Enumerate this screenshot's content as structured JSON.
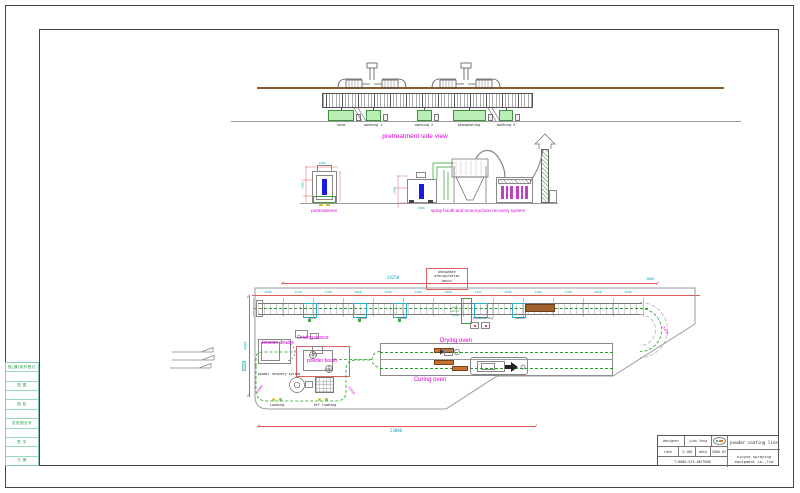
{
  "frame": {
    "left_strip_rows": [
      "借(通)用件登记",
      "",
      "描 图",
      "",
      "描 校",
      "",
      "旧底图总号",
      "",
      "签 字",
      "",
      "日 期"
    ]
  },
  "side_view": {
    "caption": "pretreatment side view",
    "tanks": [
      {
        "label": "skim",
        "cx": 341
      },
      {
        "label": "washing 1",
        "cx": 373
      },
      {
        "label": "washing 2",
        "cx": 424
      },
      {
        "label": "phosphating",
        "cx": 469
      },
      {
        "label": "washing 3",
        "cx": 506
      }
    ]
  },
  "sections": {
    "pretreatment": "pretreatment",
    "spray": "spray booth and monocyclone recovery system",
    "dims": [
      {
        "text": "2200",
        "x": 303,
        "y": 184,
        "rot": -90
      },
      {
        "text": "1500",
        "x": 322,
        "y": 162
      },
      {
        "text": "2200",
        "x": 395,
        "y": 189,
        "rot": -90
      },
      {
        "text": "1500",
        "x": 421,
        "y": 207
      }
    ]
  },
  "plan": {
    "labels": {
      "tension_device": "tension device",
      "driving_device": "Driving device",
      "powder_booth": "powder booth",
      "powder_recovery": "powder recovery system",
      "drying_oven": "Drying oven",
      "curing_oven": "Curing oven",
      "loading": "Loading",
      "off_loading": "Off loading"
    },
    "stations": [
      {
        "label": "skim",
        "cx": 312
      },
      {
        "label": "wash1",
        "cx": 362
      },
      {
        "label": "wash2",
        "cx": 402
      },
      {
        "label": "phosphating",
        "cx": 483
      },
      {
        "label": "wash3",
        "cx": 520
      }
    ],
    "basin_lines": [
      "phosphate",
      "precipitation",
      "basin"
    ],
    "hot_water_lines": [
      "hot",
      "water",
      "tank"
    ],
    "radius_callouts": [
      {
        "text": "1500R",
        "x": 260,
        "y": 388,
        "rot": -55
      },
      {
        "text": "1500R",
        "x": 351,
        "y": 389,
        "rot": 55
      },
      {
        "text": "2000R",
        "x": 665,
        "y": 329,
        "rot": 60
      }
    ],
    "dims": {
      "total_top": "24250",
      "bottom": "23000",
      "left": "4500",
      "right": "1000",
      "segments": [
        {
          "text": "1500",
          "x": 268
        },
        {
          "text": "1570",
          "x": 298
        },
        {
          "text": "1700",
          "x": 328
        },
        {
          "text": "2000",
          "x": 358
        },
        {
          "text": "1650",
          "x": 388
        },
        {
          "text": "1500",
          "x": 418
        },
        {
          "text": "1000",
          "x": 448
        },
        {
          "text": "1443",
          "x": 478
        },
        {
          "text": "1500",
          "x": 508
        },
        {
          "text": "1400",
          "x": 538
        },
        {
          "text": "1700",
          "x": 568
        },
        {
          "text": "1650",
          "x": 598
        },
        {
          "text": "1500",
          "x": 628
        }
      ]
    }
  },
  "title_block": {
    "designer_label": "designer",
    "designer_value": "jian feng",
    "rate_label": "rate",
    "rate_value": "1:100",
    "date_label": "date",
    "date_value": "2006.07",
    "phone": "T:0086-523-8879566",
    "project": "powder coating line",
    "company_line1": "xinyue spraying",
    "company_line2": "equipment co.,ltd"
  }
}
